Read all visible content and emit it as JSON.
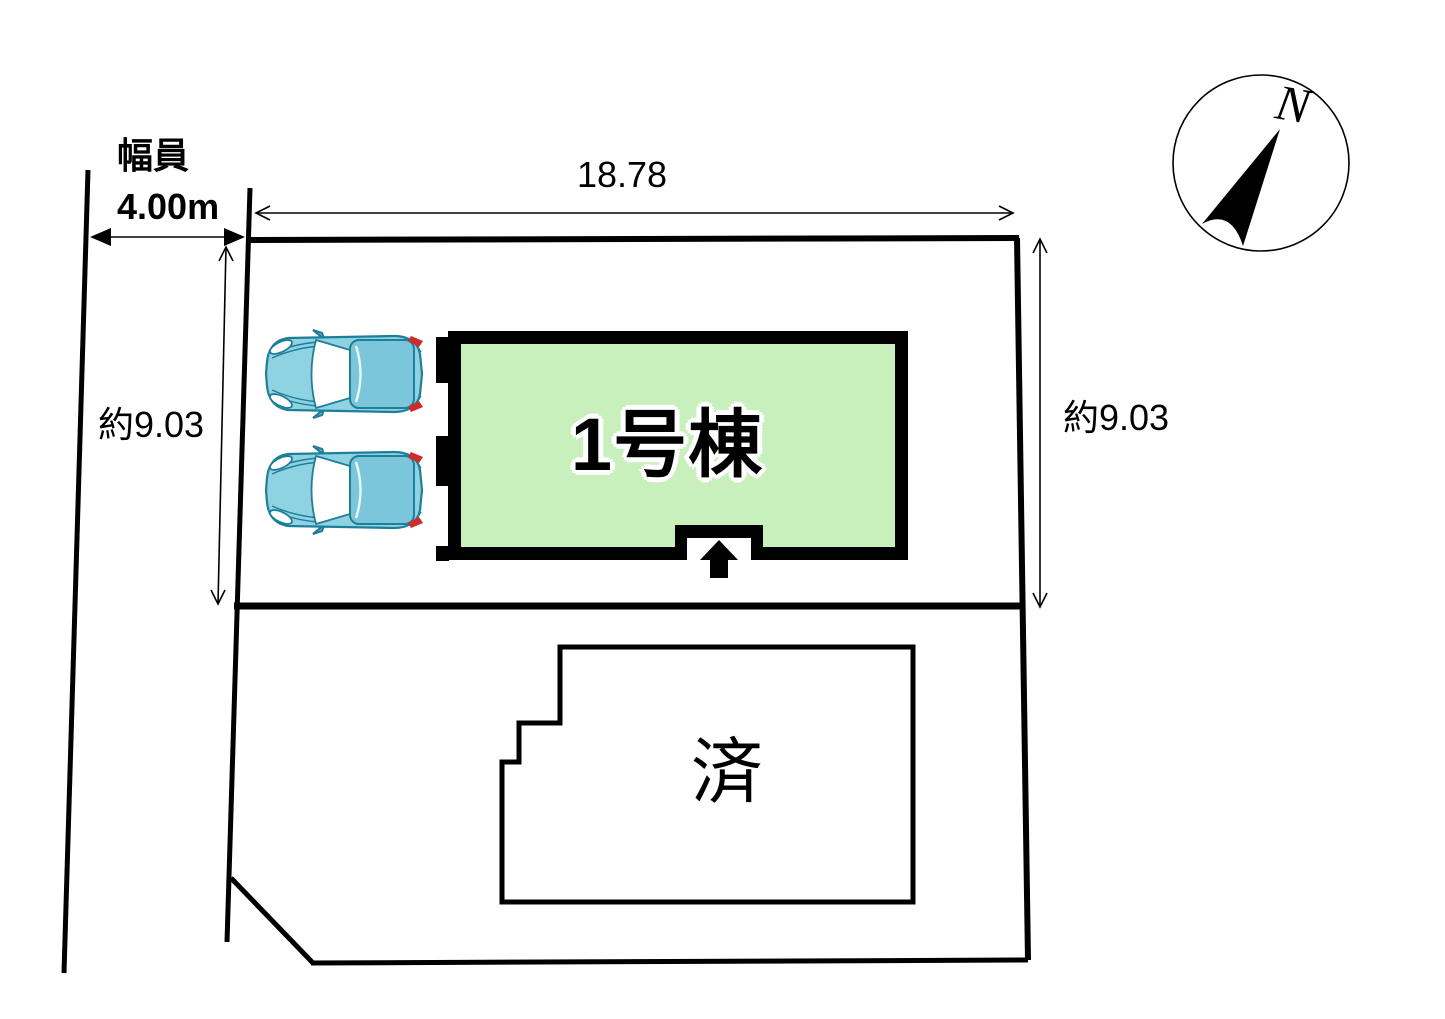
{
  "labels": {
    "road_width_label": "幅員",
    "road_width_value": "4.00m",
    "top_dimension": "18.78",
    "left_dimension": "約9.03",
    "right_dimension": "約9.03",
    "building1_label": "1号棟",
    "sold_label": "済",
    "compass_north": "N"
  },
  "colors": {
    "line": "#000000",
    "building_fill": "#c8f0bd",
    "car_body": "#8fd2e2",
    "car_roof": "#7bc6da",
    "car_outline": "#1e7f99",
    "car_taillight": "#cf2b2b"
  }
}
